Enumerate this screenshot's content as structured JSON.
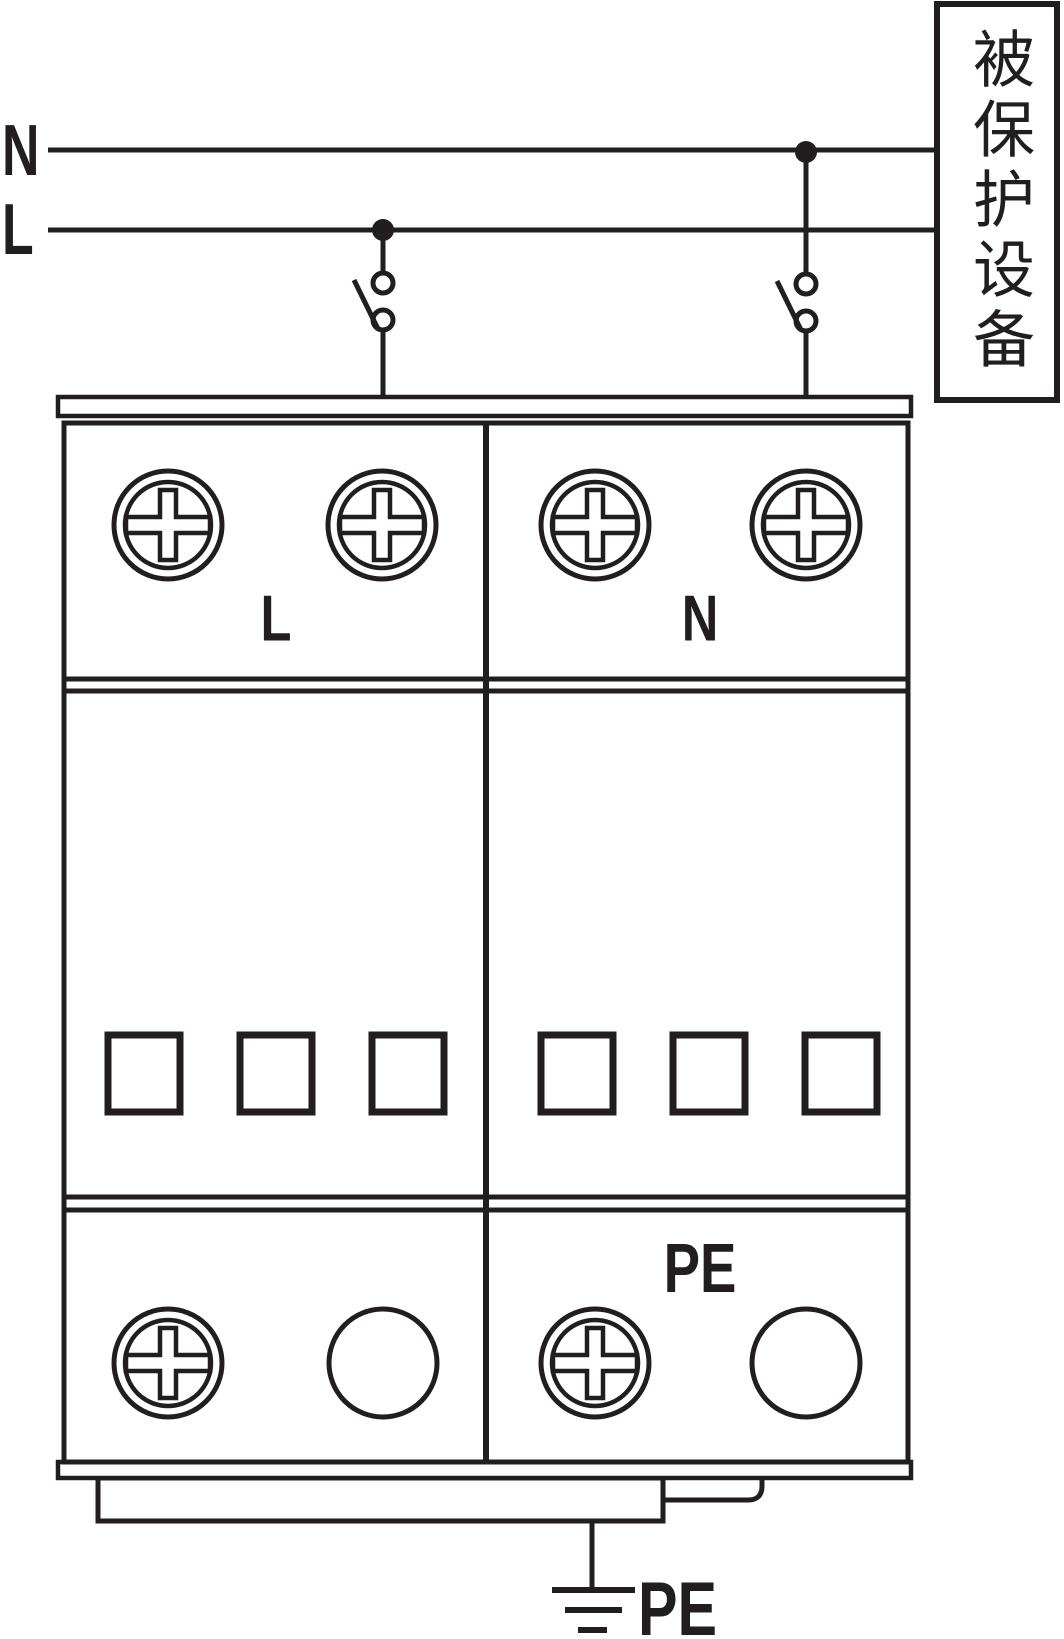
{
  "colors": {
    "ink": "#221e1f",
    "background": "#ffffff"
  },
  "wires": {
    "n_label": "N",
    "l_label": "L"
  },
  "protected_equipment": {
    "text": "被保护设备"
  },
  "device": {
    "module_l_label": "L",
    "module_n_label": "N",
    "pe_terminal_label": "PE"
  },
  "ground": {
    "pe_label": "PE"
  }
}
